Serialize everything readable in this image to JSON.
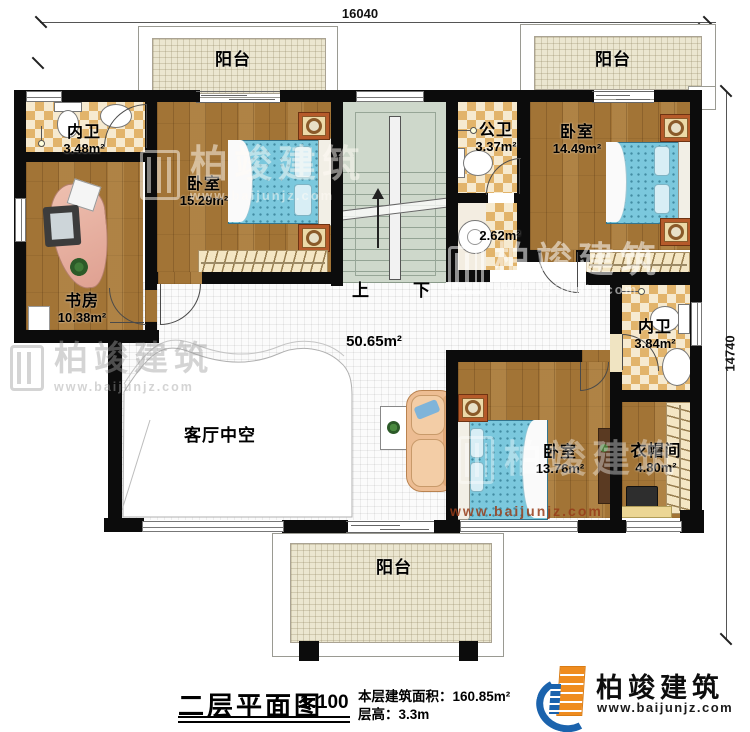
{
  "dimensions": {
    "top": "16040",
    "right": "14740"
  },
  "rooms": {
    "balcony_top_left": {
      "name": "阳台"
    },
    "balcony_top_right": {
      "name": "阳台"
    },
    "balcony_bottom": {
      "name": "阳台"
    },
    "bath_top_left": {
      "name": "内卫",
      "area": "3.48m²"
    },
    "bedroom_top_left": {
      "name": "卧室",
      "area": "15.29m²"
    },
    "public_bath": {
      "name": "公卫",
      "area": "3.37m²"
    },
    "wash_area": {
      "area": "2.62m²"
    },
    "bedroom_top_right": {
      "name": "卧室",
      "area": "14.49m²"
    },
    "study": {
      "name": "书房",
      "area": "10.38m²"
    },
    "bath_right": {
      "name": "内卫",
      "area": "3.84m²"
    },
    "hall": {
      "area": "50.65m²"
    },
    "living_void": {
      "name": "客厅中空"
    },
    "bedroom_bottom": {
      "name": "卧室",
      "area": "13.76m²"
    },
    "cloakroom": {
      "name": "衣帽间",
      "area": "4.80m²"
    }
  },
  "stairs": {
    "up": "上",
    "down": "下"
  },
  "title_block": {
    "title": "二层平面图",
    "scale": "1:100",
    "area_line": "本层建筑面积：160.85m²",
    "height_line": "层高：3.3m"
  },
  "brand": {
    "name": "柏竣建筑",
    "website": "www.baijunjz.com"
  },
  "watermark": {
    "name": "柏竣建筑",
    "website": "www.baijunjz.com"
  },
  "colors": {
    "wall": "#0c0c0c",
    "wood": "#a27436",
    "checker": "#e2b46b",
    "bed": "#7bc8dd",
    "brand_blue": "#1b63ad",
    "brand_orange": "#ef8c1f"
  }
}
